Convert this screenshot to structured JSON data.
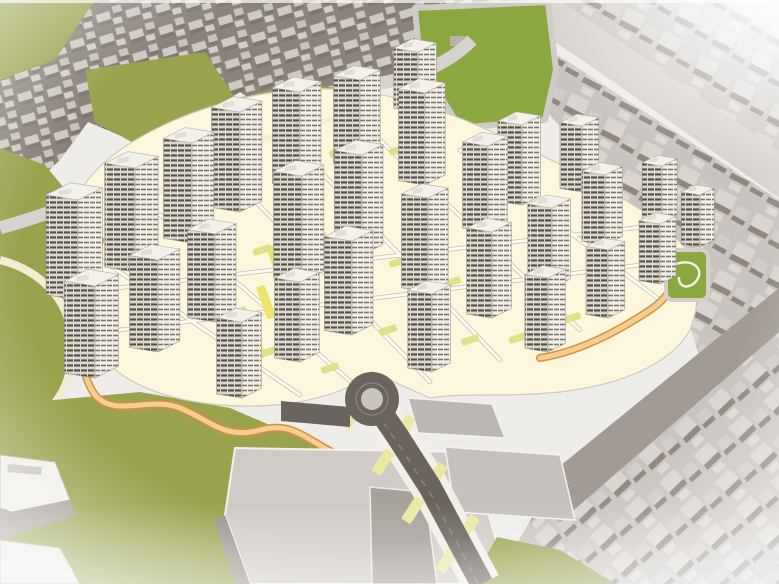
{
  "meta": {
    "content_type": "architectural-3d-render",
    "subject": "aerial-birds-eye-view-of-residential-masterplan",
    "visible_text": "none"
  },
  "palette": {
    "base_ground": "#efedea",
    "city_ground_dark": "#8a827b",
    "city_roof": "#cfcac3",
    "city_side": "#7e766f",
    "right_city_base": "#c9c4bf",
    "right_city_roof": "#d9d4ce",
    "right_city_side": "#928a83",
    "olive_green": "#9aa24e",
    "bright_green": "#8ba73f",
    "site_cream": "#fcf7dd",
    "trail_orange_fill": "#f5cf92",
    "trail_orange_edge": "#d68f42",
    "road_dark": "#6b645e",
    "road_light": "#d6d2ce",
    "road_mid": "#a29b95",
    "yellow_median": "#ece46f",
    "lawn_yellow_green": "#dde187",
    "tower_face_lit": "#f1eee7",
    "tower_face_shade": "#dbd7cc",
    "tower_window_stripe": "#524d46",
    "tower_roof": "#f3f1eb",
    "podium_roof": "#d0cbc6",
    "white": "#ffffff"
  },
  "scene": {
    "regions": [
      "existing-city-fabric-top-left",
      "existing-city-fabric-right",
      "green-hill-top-left",
      "green-open-space-top-center",
      "park-belt-northwest",
      "green-slope-west",
      "green-field-southwest",
      "pocket-park-east",
      "development-site",
      "main-road-with-roundabout",
      "podium-buildings-south"
    ],
    "tower_count": 29,
    "towers": [
      [
        418,
        112,
        44,
        60
      ],
      [
        360,
        168,
        48,
        88
      ],
      [
        300,
        188,
        50,
        96
      ],
      [
        425,
        185,
        48,
        92
      ],
      [
        582,
        192,
        40,
        66
      ],
      [
        522,
        205,
        44,
        80
      ],
      [
        240,
        212,
        52,
        100
      ],
      [
        662,
        222,
        36,
        56
      ],
      [
        488,
        232,
        46,
        86
      ],
      [
        192,
        243,
        52,
        100
      ],
      [
        605,
        245,
        42,
        70
      ],
      [
        700,
        247,
        34,
        52
      ],
      [
        362,
        255,
        50,
        100
      ],
      [
        135,
        272,
        55,
        104
      ],
      [
        302,
        282,
        52,
        106
      ],
      [
        660,
        284,
        38,
        60
      ],
      [
        552,
        288,
        44,
        80
      ],
      [
        428,
        292,
        48,
        94
      ],
      [
        78,
        300,
        58,
        100
      ],
      [
        608,
        318,
        40,
        68
      ],
      [
        492,
        318,
        46,
        86
      ],
      [
        215,
        322,
        50,
        88
      ],
      [
        352,
        335,
        50,
        94
      ],
      [
        158,
        352,
        52,
        92
      ],
      [
        548,
        352,
        42,
        74
      ],
      [
        300,
        362,
        46,
        80
      ],
      [
        432,
        372,
        44,
        78
      ],
      [
        95,
        378,
        56,
        92
      ],
      [
        242,
        398,
        46,
        76
      ]
    ],
    "lawns": [
      [
        262,
        250
      ],
      [
        318,
        238
      ],
      [
        292,
        300
      ],
      [
        352,
        300
      ],
      [
        238,
        312
      ],
      [
        398,
        262
      ],
      [
        452,
        282
      ],
      [
        470,
        340
      ],
      [
        388,
        330
      ],
      [
        268,
        352
      ],
      [
        330,
        368
      ],
      [
        518,
        338
      ],
      [
        572,
        318
      ],
      [
        338,
        152
      ],
      [
        398,
        150
      ]
    ],
    "yellow_medians": [
      [
        286,
        222
      ],
      [
        276,
        262
      ],
      [
        266,
        302
      ],
      [
        256,
        342
      ]
    ],
    "road_pods": [
      [
        352,
        416
      ],
      [
        383,
        462
      ],
      [
        413,
        510
      ],
      [
        447,
        560
      ],
      [
        404,
        428
      ],
      [
        436,
        476
      ],
      [
        468,
        528
      ]
    ],
    "roundabout": {
      "cx": 372,
      "cy": 399,
      "outer_r": 27,
      "island_r": 10
    }
  }
}
